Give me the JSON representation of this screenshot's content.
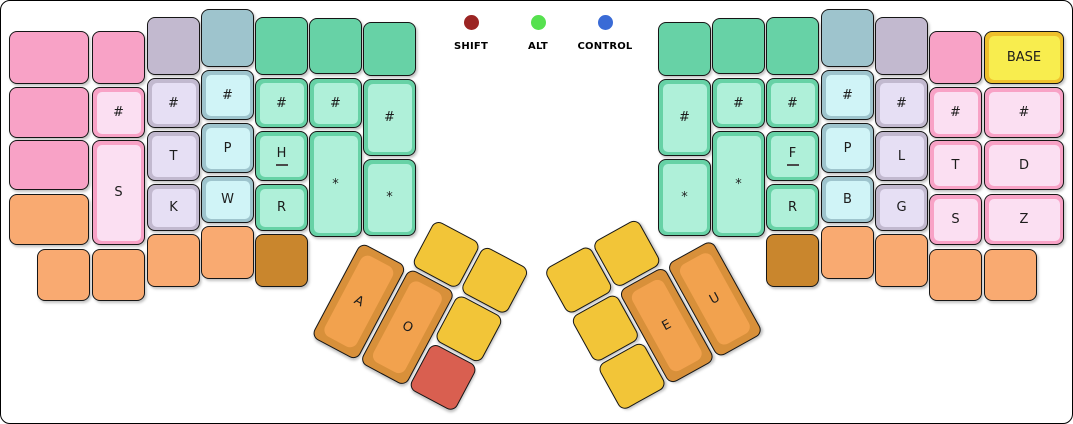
{
  "panel": {
    "background": "#ffffff",
    "border_color": "#000000"
  },
  "indicators": [
    {
      "name": "shift",
      "label": "SHIFT",
      "color": "#9B2423"
    },
    {
      "name": "alt",
      "label": "ALT",
      "color": "#56E14F"
    },
    {
      "name": "control",
      "label": "CONTROL",
      "color": "#3A6BD6"
    }
  ],
  "palette": {
    "pink": {
      "outer": "#F8A2C6",
      "inner": "#FBDFF2"
    },
    "lavender": {
      "outer": "#C2B9CF",
      "inner": "#E6DFF4"
    },
    "blue": {
      "outer": "#9EC4CD",
      "inner": "#D0F4F7"
    },
    "green": {
      "outer": "#67D2A6",
      "inner": "#AFF0D9"
    },
    "orange": {
      "outer": "#F9AA71"
    },
    "darkorange": {
      "outer": "#C9862D"
    },
    "yellow": {
      "outer": "#F2C538"
    },
    "red": {
      "outer": "#D95F50"
    },
    "thumb": {
      "outer": "#D8903A",
      "inner": "#F2A24E"
    },
    "base": {
      "outer": "#EFC02C",
      "inner": "#F8ED4E"
    }
  },
  "main_keys": [
    [
      "l-edge-r1",
      "",
      "pink",
      8,
      30,
      80,
      53
    ],
    [
      "l-edge-r2",
      "",
      "pink",
      8,
      86,
      80,
      51
    ],
    [
      "l-edge-r3",
      "",
      "pink",
      8,
      139,
      80,
      50
    ],
    [
      "l-edge-r4",
      "",
      "orange",
      8,
      193,
      80,
      51
    ],
    [
      "l-pinky-r1",
      "",
      "pink",
      91,
      30,
      53,
      53
    ],
    [
      "l-pinky-number",
      "#",
      "pink",
      91,
      86,
      53,
      51
    ],
    [
      "l-S",
      "S",
      "pink",
      91,
      139,
      53,
      105
    ],
    [
      "l-bottom-1",
      "",
      "orange",
      36,
      248,
      53,
      52
    ],
    [
      "l-bottom-2",
      "",
      "orange",
      91,
      248,
      53,
      52
    ],
    [
      "l-ring-r1",
      "",
      "lavender",
      146,
      16,
      53,
      58
    ],
    [
      "l-ring-number",
      "#",
      "lavender",
      146,
      77,
      53,
      50
    ],
    [
      "l-T",
      "T",
      "lavender",
      146,
      130,
      53,
      50
    ],
    [
      "l-K",
      "K",
      "lavender",
      146,
      183,
      53,
      47
    ],
    [
      "l-ring-bottom",
      "",
      "orange",
      146,
      233,
      53,
      53
    ],
    [
      "l-middle-r1",
      "",
      "blue",
      200,
      8,
      53,
      58
    ],
    [
      "l-middle-number",
      "#",
      "blue",
      200,
      69,
      53,
      50
    ],
    [
      "l-P",
      "P",
      "blue",
      200,
      122,
      53,
      50
    ],
    [
      "l-W",
      "W",
      "blue",
      200,
      175,
      53,
      47
    ],
    [
      "l-middle-bottom",
      "",
      "orange",
      200,
      225,
      53,
      53
    ],
    [
      "l-index-r1",
      "",
      "green",
      254,
      16,
      53,
      58
    ],
    [
      "l-index-number",
      "#",
      "green",
      254,
      77,
      53,
      50
    ],
    [
      "l-H",
      "H",
      "green",
      254,
      130,
      53,
      50,
      "home"
    ],
    [
      "l-R",
      "R",
      "green",
      254,
      183,
      53,
      47
    ],
    [
      "l-index-bottom",
      "",
      "darkorange",
      254,
      233,
      53,
      53
    ],
    [
      "l-inner-r1",
      "",
      "green",
      308,
      17,
      53,
      56
    ],
    [
      "l-inner-number",
      "#",
      "green",
      308,
      77,
      53,
      50
    ],
    [
      "l-star-tall",
      "*",
      "green",
      308,
      130,
      53,
      106
    ],
    [
      "l-innermost-r1",
      "",
      "green",
      362,
      21,
      53,
      54
    ],
    [
      "l-innermost-number",
      "#",
      "green",
      362,
      78,
      53,
      77
    ],
    [
      "l-innermost-star",
      "*",
      "green",
      362,
      158,
      53,
      77
    ],
    [
      "r-innermost-r1",
      "",
      "green",
      657,
      21,
      53,
      54
    ],
    [
      "r-innermost-number",
      "#",
      "green",
      657,
      78,
      53,
      77
    ],
    [
      "r-innermost-star",
      "*",
      "green",
      657,
      158,
      53,
      77
    ],
    [
      "r-inner-r1",
      "",
      "green",
      711,
      17,
      53,
      56
    ],
    [
      "r-inner-number",
      "#",
      "green",
      711,
      77,
      53,
      50
    ],
    [
      "r-star-tall",
      "*",
      "green",
      711,
      130,
      53,
      106
    ],
    [
      "r-index-r1",
      "",
      "green",
      765,
      16,
      53,
      58
    ],
    [
      "r-index-number",
      "#",
      "green",
      765,
      77,
      53,
      50
    ],
    [
      "r-F",
      "F",
      "green",
      765,
      130,
      53,
      50,
      "home"
    ],
    [
      "r-R",
      "R",
      "green",
      765,
      183,
      53,
      47
    ],
    [
      "r-index-bottom",
      "",
      "darkorange",
      765,
      233,
      53,
      53
    ],
    [
      "r-middle-r1",
      "",
      "blue",
      820,
      8,
      53,
      58
    ],
    [
      "r-middle-number",
      "#",
      "blue",
      820,
      69,
      53,
      50
    ],
    [
      "r-P",
      "P",
      "blue",
      820,
      122,
      53,
      50
    ],
    [
      "r-B",
      "B",
      "blue",
      820,
      175,
      53,
      47
    ],
    [
      "r-middle-bottom",
      "",
      "orange",
      820,
      225,
      53,
      53
    ],
    [
      "r-ring-r1",
      "",
      "lavender",
      874,
      16,
      53,
      58
    ],
    [
      "r-ring-number",
      "#",
      "lavender",
      874,
      77,
      53,
      50
    ],
    [
      "r-L",
      "L",
      "lavender",
      874,
      130,
      53,
      50
    ],
    [
      "r-G",
      "G",
      "lavender",
      874,
      183,
      53,
      47
    ],
    [
      "r-ring-bottom",
      "",
      "orange",
      874,
      233,
      53,
      53
    ],
    [
      "r-pinky-r1",
      "",
      "pink",
      928,
      30,
      53,
      53
    ],
    [
      "r-pinky-number",
      "#",
      "pink",
      928,
      86,
      53,
      51
    ],
    [
      "r-T",
      "T",
      "pink",
      928,
      139,
      53,
      50
    ],
    [
      "r-S",
      "S",
      "pink",
      928,
      193,
      53,
      51
    ],
    [
      "r-pinky-bottom",
      "",
      "orange",
      928,
      248,
      53,
      52
    ],
    [
      "r-base",
      "BASE",
      "base",
      983,
      30,
      80,
      53
    ],
    [
      "r-edge-number",
      "#",
      "pink",
      983,
      86,
      80,
      51
    ],
    [
      "r-D",
      "D",
      "pink",
      983,
      139,
      80,
      50
    ],
    [
      "r-Z",
      "Z",
      "pink",
      983,
      193,
      80,
      51
    ],
    [
      "r-edge-bottom",
      "",
      "orange",
      983,
      248,
      53,
      52
    ]
  ],
  "thumb_left": {
    "x": 360,
    "y": 241,
    "angle": 28,
    "keys": [
      [
        "lt-top-1",
        "",
        "yellow",
        55,
        -55,
        52,
        52
      ],
      [
        "lt-top-2",
        "",
        "yellow",
        110,
        -55,
        52,
        52
      ],
      [
        "lt-A",
        "A",
        "thumb",
        0,
        0,
        52,
        107,
        "big"
      ],
      [
        "lt-O",
        "O",
        "thumb",
        55,
        0,
        52,
        107,
        "big"
      ],
      [
        "lt-side",
        "",
        "yellow",
        110,
        0,
        52,
        52
      ],
      [
        "lt-held",
        "",
        "red",
        110,
        55,
        52,
        52
      ]
    ]
  },
  "thumb_right": {
    "x": 569,
    "y": 317,
    "angle": -29,
    "keys": [
      [
        "rt-top-1",
        "",
        "yellow",
        55,
        -55,
        52,
        52
      ],
      [
        "rt-top-2",
        "",
        "yellow",
        0,
        -55,
        52,
        52
      ],
      [
        "rt-side",
        "",
        "yellow",
        0,
        0,
        52,
        52
      ],
      [
        "rt-low",
        "",
        "yellow",
        0,
        55,
        52,
        52
      ],
      [
        "rt-E",
        "E",
        "thumb",
        55,
        0,
        52,
        107,
        "big"
      ],
      [
        "rt-U",
        "U",
        "thumb",
        110,
        0,
        52,
        107,
        "big"
      ]
    ]
  }
}
